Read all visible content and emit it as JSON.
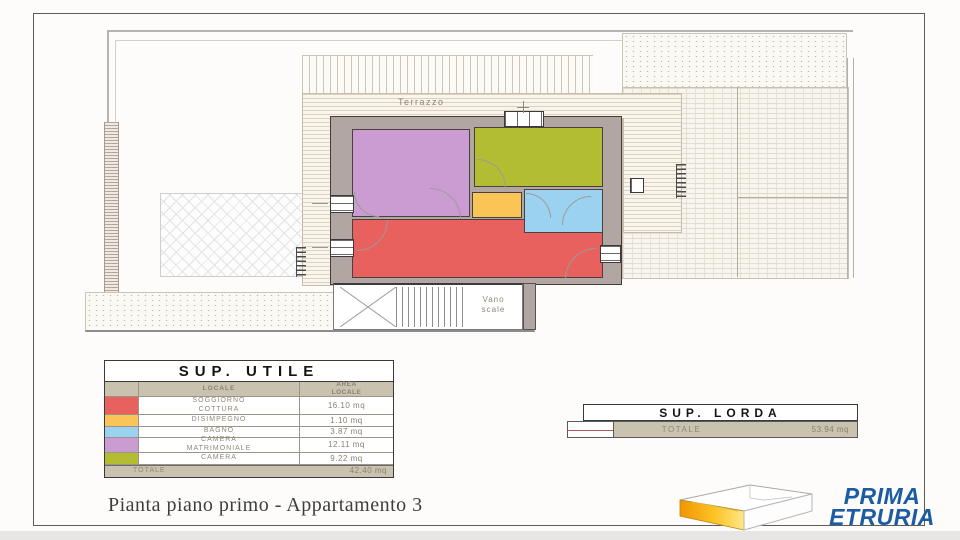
{
  "plan": {
    "labels": {
      "terrazzo": "Terrazzo",
      "vano_scale": "Vano\nscale"
    }
  },
  "colors": {
    "soggiorno": "#e8615e",
    "disimpegno": "#fbc457",
    "bagno": "#9bd2ef",
    "camera_matrimoniale": "#ca9cd2",
    "camera": "#b2bd31",
    "wall": "#b2a6a2",
    "table_beige": "#c9c2af",
    "logo_blue": "#1c5ca4"
  },
  "sup_utile": {
    "title": "SUP. UTILE",
    "columns": {
      "locale": "LOCALE",
      "area": "AREA\nLOCALE"
    },
    "rows": [
      {
        "name": "SOGGIORNO\nCOTTURA",
        "area": "16.10 mq"
      },
      {
        "name": "DISIMPEGNO",
        "area": "1.10 mq"
      },
      {
        "name": "BAGNO",
        "area": "3.87 mq"
      },
      {
        "name": "CAMERA\nMATRIMONIALE",
        "area": "12.11 mq"
      },
      {
        "name": "CAMERA",
        "area": "9.22 mq"
      }
    ],
    "total": {
      "label": "TOTALE",
      "value": "42.40 mq"
    }
  },
  "sup_lorda": {
    "title": "SUP. LORDA",
    "total": {
      "label": "TOTALE",
      "value": "53.94 mq"
    }
  },
  "title_block": {
    "text": "Pianta piano primo - Appartamento 3"
  },
  "logo": {
    "line1": "PRIMA",
    "line2": "ETRURIA"
  }
}
